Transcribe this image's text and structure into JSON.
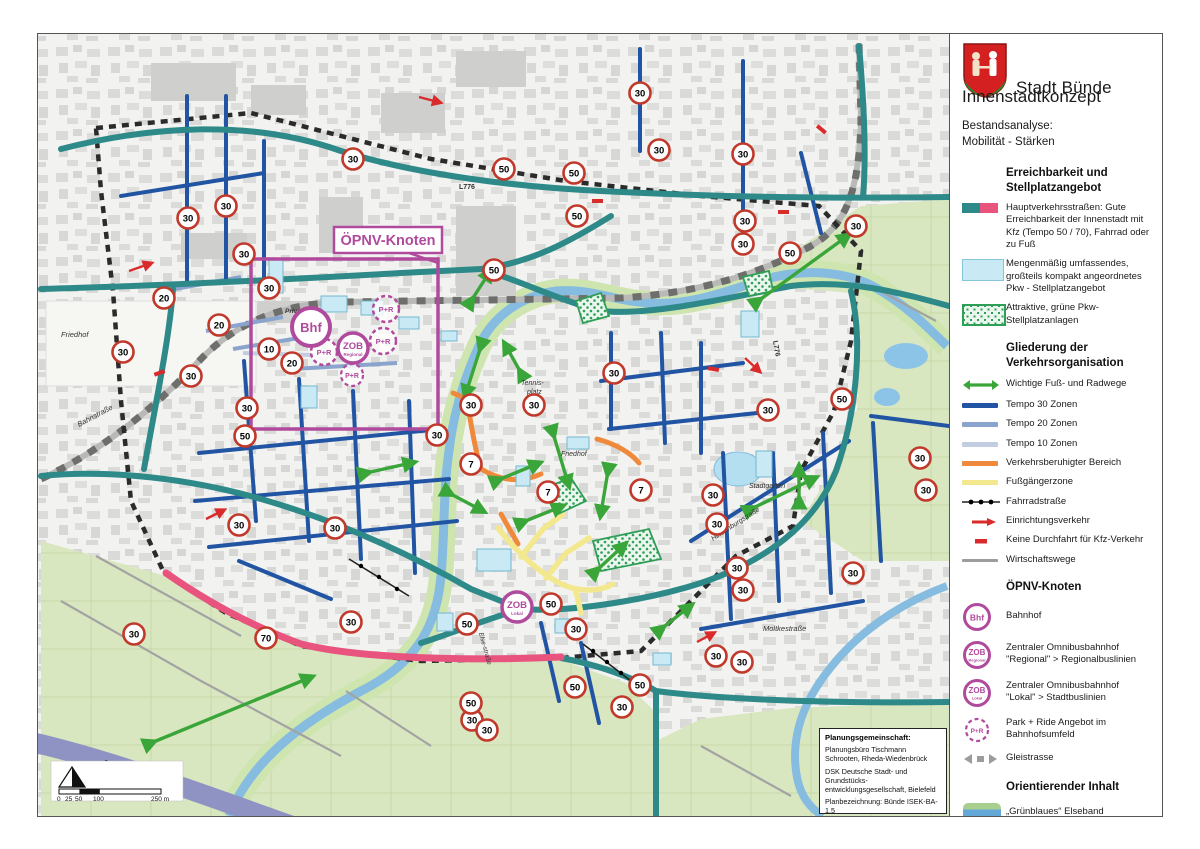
{
  "title": {
    "city": "Stadt Bünde",
    "subtitle": "Innenstadtkonzept",
    "analysis_line1": "Bestandsanalyse:",
    "analysis_line2": "Mobilität - Stärken"
  },
  "legend": {
    "section1": {
      "heading": "Erreichbarkeit und Stellplatzangebot",
      "items": [
        "Hauptverkehrsstraßen: Gute Erreichbarkeit der Innenstadt mit Kfz (Tempo 50 / 70), Fahrrad oder zu Fuß",
        "Mengenmäßig umfassendes, großteils kompakt angeordnetes Pkw - Stellplatz­angebot",
        "Attraktive, grüne Pkw-Stellplatzanlagen"
      ]
    },
    "section2": {
      "heading": "Gliederung der Verkehrsorganisation",
      "items": [
        "Wichtige Fuß- und Radwege",
        "Tempo 30 Zonen",
        "Tempo 20 Zonen",
        "Tempo 10 Zonen",
        "Verkehrsberuhigter Bereich",
        "Fußgängerzone",
        "Fahrradstraße",
        "Einrichtungsverkehr",
        "Keine Durchfahrt für Kfz-Verkehr",
        "Wirtschaftswege"
      ]
    },
    "section3": {
      "heading": "ÖPNV-Knoten",
      "items": [
        "Bahnhof",
        "Zentraler Omnibusbahnhof \"Regional\" > Regionalbuslinien",
        "Zentraler Omnibusbahnhof \"Lokal\" > Stadtbuslinien",
        "Park + Ride Angebot im Bahnhofsumfeld",
        "Gleistrasse"
      ]
    },
    "section4": {
      "heading": "Orientierender Inhalt",
      "items": [
        "„Grünblaues“ Elseband",
        "A30",
        "Untersuchungsgebiet"
      ]
    }
  },
  "markers": {
    "bhf": "Bhf",
    "zob": "ZOB",
    "zob_regional_sub": "Regional",
    "zob_lokal_sub": "Lokal",
    "pr": "P+R"
  },
  "signs": {
    "s30": "30",
    "s50": "50",
    "s70": "70",
    "s7": "7",
    "s10": "10",
    "s20": "20"
  },
  "map_labels": {
    "opnv": "ÖPNV-Knoten",
    "a30": "A 30",
    "l776": "L776",
    "l776b": "L776",
    "friedhof_west": "Friedhof",
    "friedhof_center": "Friedhof",
    "bahnstrasse": "Bahnstraße",
    "tennis1": "Tennis-",
    "tennis2": "platz",
    "stadtgarten": "Stadtgarten",
    "moltkestrasse": "Moltkestraße",
    "hindenburgstrasse": "Hindenburgstraße",
    "elsestrasse": "Else-straße",
    "privat": "Privat!"
  },
  "infobox": {
    "title": "Planungsgemeinschaft:",
    "p1": "Planungsbüro Tischmann Schrooten, Rheda-Wiedenbrück",
    "p2": "DSK Deutsche Stadt- und Grundstücks­entwicklungsgesellschaft, Bielefeld",
    "p3": "Planbezeichnung: Bünde ISEK-BA-1.5",
    "p4": "Stand: 29.09.2017"
  },
  "scalebar": {
    "t0": "0",
    "t25": "25",
    "t50": "50",
    "t100": "100",
    "t250": "250 m"
  },
  "colors": {
    "main_road_teal": "#2E8989",
    "main_road_pink": "#E8547E",
    "tempo30": "#2155A3",
    "tempo20": "#8AA4CE",
    "tempo10": "#C3CDE2",
    "calmed_orange": "#EF8A3D",
    "pedestrian_yellow": "#F3E88E",
    "footbike_green": "#3AA63A",
    "oneway_red": "#D92B2B",
    "opnv_magenta": "#B04A9C",
    "parking_blue": "#C9E9F4",
    "parking_green": "#2F9E57",
    "a30_band": "#8E93C4",
    "river_blue": "#86BCDF",
    "field_green": "#D9E7C0"
  }
}
